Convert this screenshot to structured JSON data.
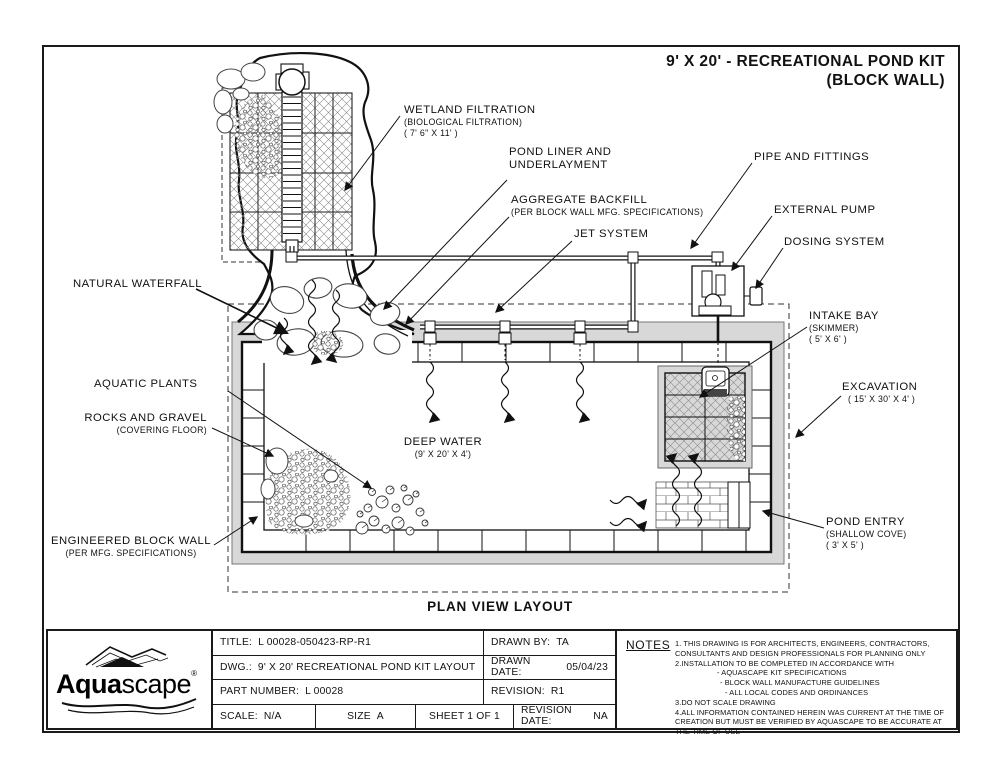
{
  "sheet": {
    "title_line1": "9' X 20' - RECREATIONAL POND KIT",
    "title_line2": "(BLOCK WALL)",
    "plan_caption": "PLAN VIEW LAYOUT"
  },
  "callouts": {
    "wetland_filtration": {
      "name": "WETLAND FILTRATION",
      "sub1": "(BIOLOGICAL FILTRATION)",
      "sub2": "( 7' 6\" X 11' )"
    },
    "pond_liner": {
      "name1": "POND LINER AND",
      "name2": "UNDERLAYMENT"
    },
    "aggregate_backfill": {
      "name": "AGGREGATE BACKFILL",
      "sub1": "(PER BLOCK WALL MFG. SPECIFICATIONS)"
    },
    "jet_system": {
      "name": "JET SYSTEM"
    },
    "pipe_and_fittings": {
      "name": "PIPE AND FITTINGS"
    },
    "external_pump": {
      "name": "EXTERNAL PUMP"
    },
    "dosing_system": {
      "name": "DOSING SYSTEM"
    },
    "intake_bay": {
      "name": "INTAKE BAY",
      "sub1": "(SKIMMER)",
      "sub2": "( 5' X 6' )"
    },
    "excavation": {
      "name": "EXCAVATION",
      "sub1": "( 15' X 30' X 4' )"
    },
    "natural_waterfall": {
      "name": "NATURAL WATERFALL"
    },
    "aquatic_plants": {
      "name": "AQUATIC PLANTS"
    },
    "rocks_and_gravel": {
      "name": "ROCKS AND GRAVEL",
      "sub1": "(COVERING FLOOR)"
    },
    "deep_water": {
      "name": "DEEP WATER",
      "sub1": "(9' X 20' X 4')"
    },
    "engineered_block_wall": {
      "name": "ENGINEERED BLOCK WALL",
      "sub1": "(PER MFG. SPECIFICATIONS)"
    },
    "pond_entry": {
      "name": "POND ENTRY",
      "sub1": "(SHALLOW COVE)",
      "sub2": "( 3' X 5' )"
    }
  },
  "title_block": {
    "title_label": "TITLE:",
    "title_value": "L 00028-050423-RP-R1",
    "drawn_by_label": "DRAWN BY:",
    "drawn_by_value": "TA",
    "dwg_label": "DWG.:",
    "dwg_value": "9' X 20' RECREATIONAL POND KIT LAYOUT",
    "drawn_date_label": "DRAWN DATE:",
    "drawn_date_value": "05/04/23",
    "part_number_label": "PART NUMBER:",
    "part_number_value": "L 00028",
    "revision_label": "REVISION:",
    "revision_value": "R1",
    "scale_label": "SCALE:",
    "scale_value": "N/A",
    "size_label": "SIZE",
    "size_value": "A",
    "sheet_value": "SHEET 1 OF 1",
    "revision_date_label": "REVISION DATE:",
    "revision_date_value": "NA"
  },
  "notes": {
    "header": "NOTES",
    "lines": [
      "1. THIS DRAWING IS FOR ARCHITECTS, ENGINEERS, CONTRACTORS,",
      "CONSULTANTS AND DESIGN PROFESSIONALS FOR PLANNING ONLY",
      "2.INSTALLATION TO BE COMPLETED IN ACCORDANCE WITH",
      "- AQUASCAPE KIT SPECIFICATIONS",
      "- BLOCK WALL MANUFACTURE GUIDELINES",
      "- ALL LOCAL CODES AND ORDINANCES",
      "3.DO NOT SCALE DRAWING",
      "4.ALL INFORMATION CONTAINED HEREIN WAS CURRENT AT THE TIME OF",
      "CREATION BUT MUST BE VERIFIED BY AQUASCAPE TO BE ACCURATE AT THE TIME OF USE"
    ]
  },
  "logo": {
    "brand_bold": "Aqua",
    "brand_rest": "scape",
    "registered": "®"
  },
  "colors": {
    "line": "#1a1a1a",
    "backfill_gray": "#d8d8d8",
    "paper": "#ffffff",
    "skimmer_dark": "#444444"
  }
}
